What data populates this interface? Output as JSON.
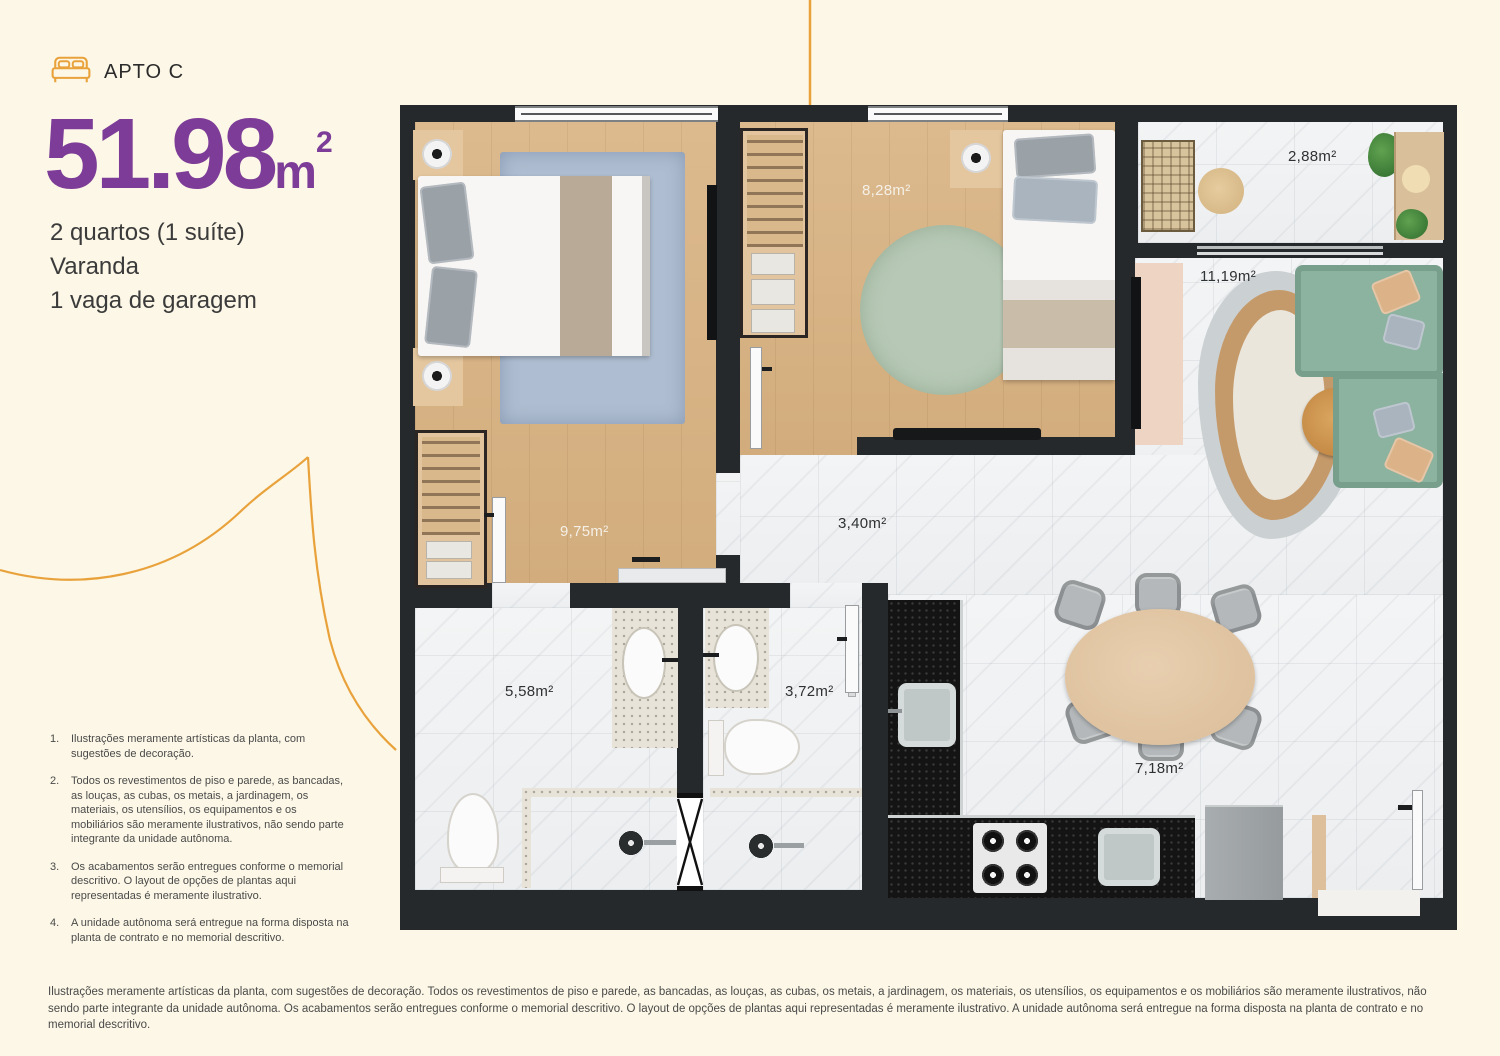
{
  "page": {
    "background": "#FCF7E6",
    "accent_orange": "#E9A23B",
    "accent_purple": "#7C3C97",
    "wall_color": "#26292B"
  },
  "header": {
    "apto_label": "APTO C",
    "area_value": "51.98",
    "area_unit": "m",
    "area_sup": "2",
    "features": [
      "2 quartos (1 suíte)",
      "Varanda",
      "1 vaga de garagem"
    ]
  },
  "rooms": {
    "bedroom2": {
      "label": "8,28m²"
    },
    "balcony": {
      "label": "2,88m²"
    },
    "living": {
      "label": "11,19m²"
    },
    "suite": {
      "label": "9,75m²"
    },
    "hall": {
      "label": "3,40m²"
    },
    "bath_suite": {
      "label": "5,58m²"
    },
    "bath2": {
      "label": "3,72m²"
    },
    "kitchen": {
      "label": "7,18m²"
    }
  },
  "footnotes": [
    {
      "num": "1.",
      "text": "Ilustrações meramente artísticas da planta, com sugestões de decoração."
    },
    {
      "num": "2.",
      "text": "Todos os revestimentos de piso e parede, as bancadas, as louças, as cubas, os metais, a jardinagem, os materiais, os utensílios, os equipamentos e os mobiliários são meramente ilustrativos, não sendo parte integrante da unidade autônoma."
    },
    {
      "num": "3.",
      "text": "Os acabamentos serão entregues conforme o memorial descritivo. O layout de opções de plantas aqui representadas é meramente ilustrativo."
    },
    {
      "num": "4.",
      "text": "A unidade autônoma será entregue na forma disposta na planta de contrato e no memorial descritivo."
    }
  ],
  "disclaimer": "Ilustrações meramente artísticas da planta, com sugestões de decoração. Todos os revestimentos de piso e parede, as bancadas, as louças, as cubas, os metais, a jardinagem, os materiais, os utensílios, os equipamentos e os mobiliários são meramente ilustrativos, não sendo parte integrante da unidade autônoma. Os acabamentos serão entregues conforme o memorial descritivo. O layout de opções de plantas aqui representadas é meramente ilustrativo. A unidade autônoma será entregue na forma disposta na planta de contrato e no memorial descritivo."
}
